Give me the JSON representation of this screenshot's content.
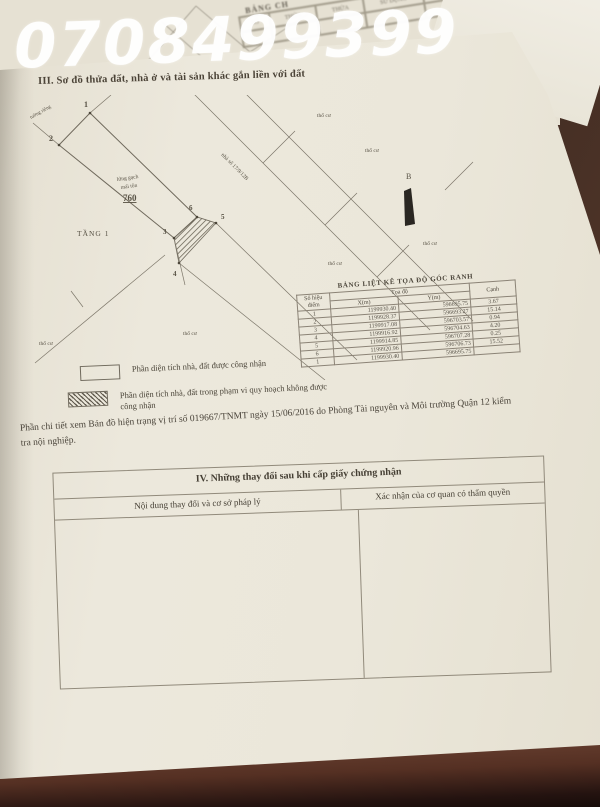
{
  "watermark": {
    "phone": "0708499399"
  },
  "background_page": {
    "table_title": "BẢNG CH",
    "columns": [
      "SỐ",
      "THỬA",
      "THỬA",
      "SỬ DỤNG",
      "CẤP IV",
      "DIỆN TÍCH"
    ]
  },
  "section3": {
    "title": "III. Sơ đồ thửa đất, nhà ở và tài sản khác gắn liền với đất",
    "diagram": {
      "parcel_number": "760",
      "floor_label": "TẦNG 1",
      "north_label": "B",
      "points": [
        "1",
        "2",
        "3",
        "4",
        "5",
        "6"
      ],
      "attic_label": "lửng gạch",
      "roof_label": "mái tôn",
      "wall_label": "tường riêng",
      "house_label": "nhà số 17/9/12B",
      "land_labels": [
        "thổ cư",
        "thổ cư",
        "thổ cư",
        "thổ cư",
        "thổ cư",
        "thổ cư"
      ]
    },
    "coord_table": {
      "title": "BẢNG LIỆT KÊ TỌA ĐỘ GÓC RANH",
      "col_point_line1": "Số hiệu",
      "col_point_line2": "điểm",
      "col_coord": "Tọa độ",
      "col_x": "X(m)",
      "col_y": "Y(m)",
      "col_edge": "Cạnh",
      "rows": [
        [
          "1",
          "1199930.40",
          "596695.75",
          "3.67"
        ],
        [
          "2",
          "1199928.37",
          "596693.27",
          "15.14"
        ],
        [
          "3",
          "1199917.08",
          "596703.57",
          "0.94"
        ],
        [
          "4",
          "1199916.92",
          "596704.63",
          "4.20"
        ],
        [
          "5",
          "1199914.85",
          "596707.28",
          "0.25"
        ],
        [
          "6",
          "1199920.96",
          "596706.73",
          "15.52"
        ],
        [
          "1",
          "1199930.40",
          "596695.75",
          ""
        ]
      ]
    },
    "legend": {
      "item1": "Phần diện tích nhà, đất được công nhận",
      "item2": "Phần diện tích nhà, đất trong phạm vi quy hoạch không được công nhận"
    },
    "note": "Phần chi tiết xem Bản đồ hiện trạng vị trí số 019667/TNMT ngày 15/06/2016 do Phòng Tài nguyên và Môi trường Quận 12 kiểm tra nội nghiệp."
  },
  "section4": {
    "title": "IV. Những thay đổi sau khi cấp giấy chứng nhận",
    "col_content": "Nội dung thay đổi và cơ sở pháp lý",
    "col_confirm": "Xác nhận của cơ quan có thẩm quyền"
  },
  "colors": {
    "paper": "#eae6da",
    "wood_dark": "#3e2c24",
    "wood_red": "#6d4434",
    "ink": "#4a443a",
    "print_line": "#8b8376",
    "watermark": "#ffffff"
  }
}
